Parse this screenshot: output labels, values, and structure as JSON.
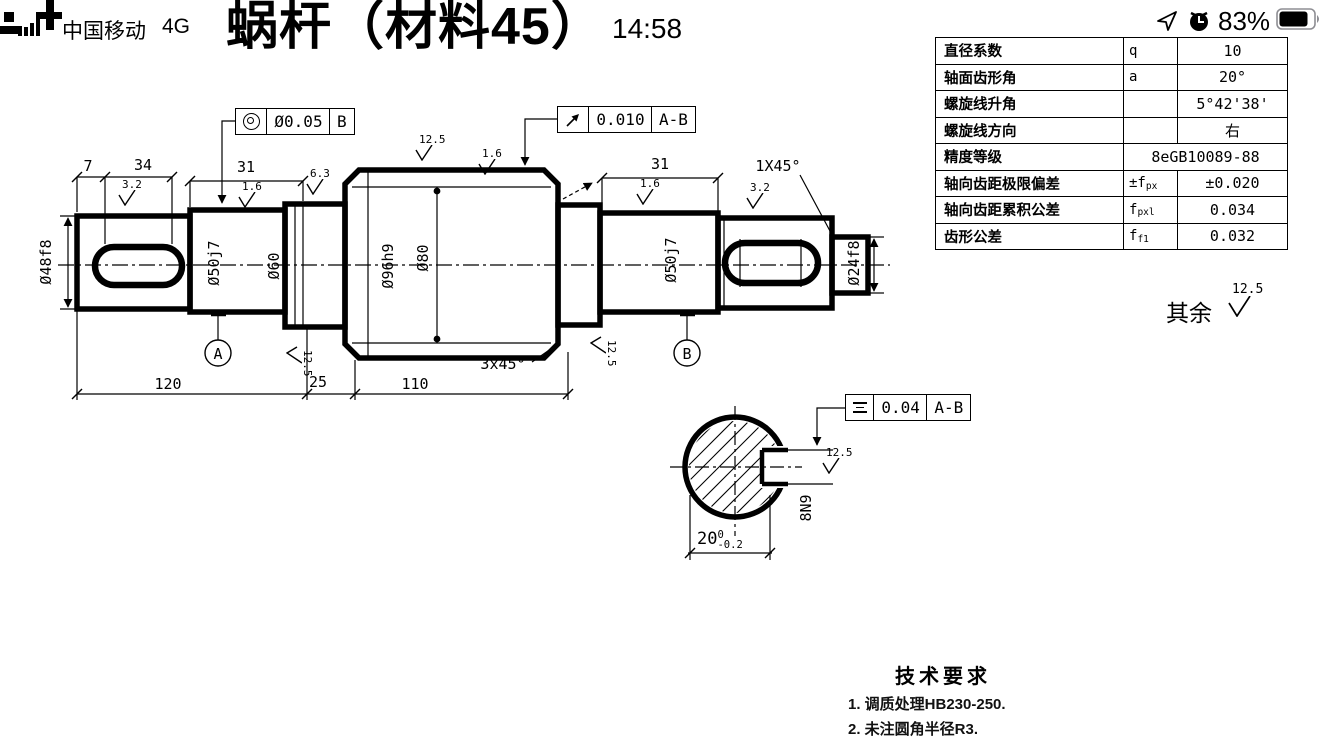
{
  "status_bar": {
    "carrier": "中国移动",
    "network": "4G",
    "time": "14:58",
    "battery_percent": "83%",
    "icons": [
      "signal-bars-icon",
      "location-arrow-icon",
      "alarm-clock-icon",
      "battery-icon"
    ]
  },
  "title": "蜗杆（材料45）",
  "params_table": {
    "rows": [
      {
        "label": "直径系数",
        "sym": "q",
        "sym_sub": "",
        "value": "10",
        "merged": false
      },
      {
        "label": "轴面齿形角",
        "sym": "a",
        "sym_sub": "",
        "value": "20°",
        "merged": false
      },
      {
        "label": "螺旋线升角",
        "sym": "",
        "sym_sub": "",
        "value": "5°42'38'",
        "merged": false
      },
      {
        "label": "螺旋线方向",
        "sym": "",
        "sym_sub": "",
        "value": "右",
        "merged": false
      },
      {
        "label": "精度等级",
        "sym": "",
        "sym_sub": "",
        "value": "8eGB10089-88",
        "merged": true
      },
      {
        "label": "轴向齿距极限偏差",
        "sym": "±f",
        "sym_sub": "px",
        "value": "±0.020",
        "merged": false
      },
      {
        "label": "轴向齿距累积公差",
        "sym": "f",
        "sym_sub": "pxl",
        "value": "0.034",
        "merged": false
      },
      {
        "label": "齿形公差",
        "sym": "f",
        "sym_sub": "f1",
        "value": "0.032",
        "merged": false
      }
    ]
  },
  "drawing": {
    "fcf_concentricity": {
      "symbol_icon": "concentricity-icon",
      "tolerance": "Ø0.05",
      "datum": "B"
    },
    "fcf_runout": {
      "symbol_icon": "circular-runout-icon",
      "tolerance": "0.010",
      "datum": "A-B"
    },
    "fcf_symmetry": {
      "symbol_icon": "symmetry-icon",
      "tolerance": "0.04",
      "datum": "A-B"
    },
    "dims": {
      "d7": "7",
      "d34": "34",
      "d31_left": "31",
      "d31_right": "31",
      "d120": "120",
      "d25": "25",
      "d110": "110",
      "chamfer_right": "1X45°",
      "chamfer_worm": "3x45°",
      "dia48": "Ø48f8",
      "dia50_left": "Ø50j7",
      "dia60": "Ø60",
      "dia96": "Ø96h9",
      "dia80": "Ø80",
      "dia50_right": "Ø50j7",
      "dia24": "Ø24f8"
    },
    "roughness": {
      "r1": "3.2",
      "r2": "1.6",
      "r3": "6.3",
      "r4": "12.5",
      "r5": "1.6",
      "r6": "1.6",
      "r7": "3.2",
      "r8": "12.5",
      "r9": "12.5",
      "r10": "12.5"
    },
    "datums": {
      "a": "A",
      "b": "B"
    },
    "surface_note": {
      "prefix": "其余",
      "value": "12.5"
    },
    "section_view": {
      "width_dim": "20",
      "tol_sup": "0",
      "tol_sub": "-0.2",
      "keyway": "8N9"
    }
  },
  "tech_requirements": {
    "title": "技术要求",
    "items": [
      "1. 调质处理HB230-250.",
      "2. 未注圆角半径R3."
    ]
  },
  "colors": {
    "ink": "#000000",
    "background": "#ffffff"
  }
}
